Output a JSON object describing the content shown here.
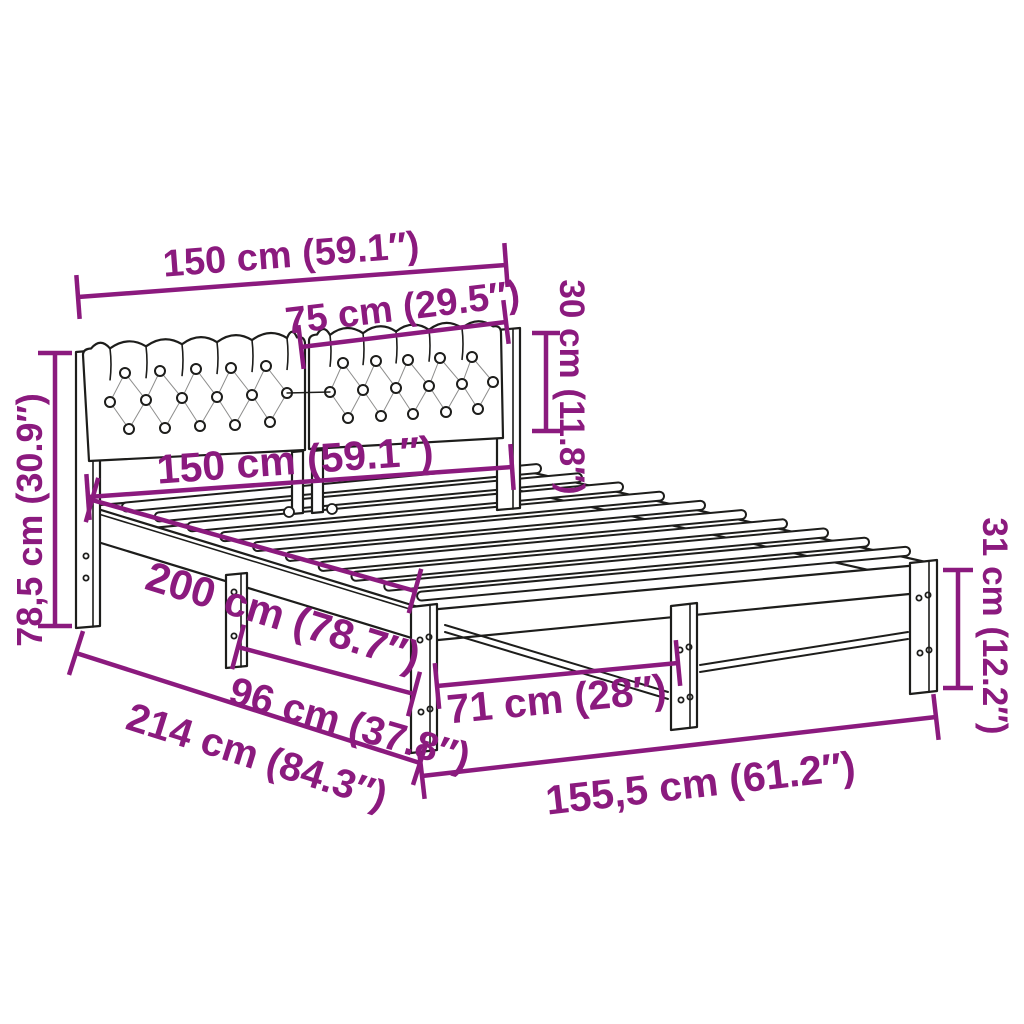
{
  "diagram": {
    "subject": "bed-frame-with-upholstered-headboard-dimension-diagram",
    "colors": {
      "accent": "#8B1A7E",
      "line": "#1d1d1b",
      "background": "#ffffff"
    },
    "dims": {
      "headboard_width": "150 cm (59.1″)",
      "cushion_width": "75 cm (29.5″)",
      "cushion_height": "30 cm (11.8″)",
      "headboard_height": "78,5 cm (30.9″)",
      "frame_width": "150 cm (59.1″)",
      "frame_length": "200 cm (78.7″)",
      "side_leg_spacing": "96 cm (37.8″)",
      "foot_leg_spacing": "71 cm (28″)",
      "total_length": "214 cm (84.3″)",
      "foot_width": "155,5 cm (61.2″)",
      "leg_height": "31 cm (12.2″)"
    }
  }
}
